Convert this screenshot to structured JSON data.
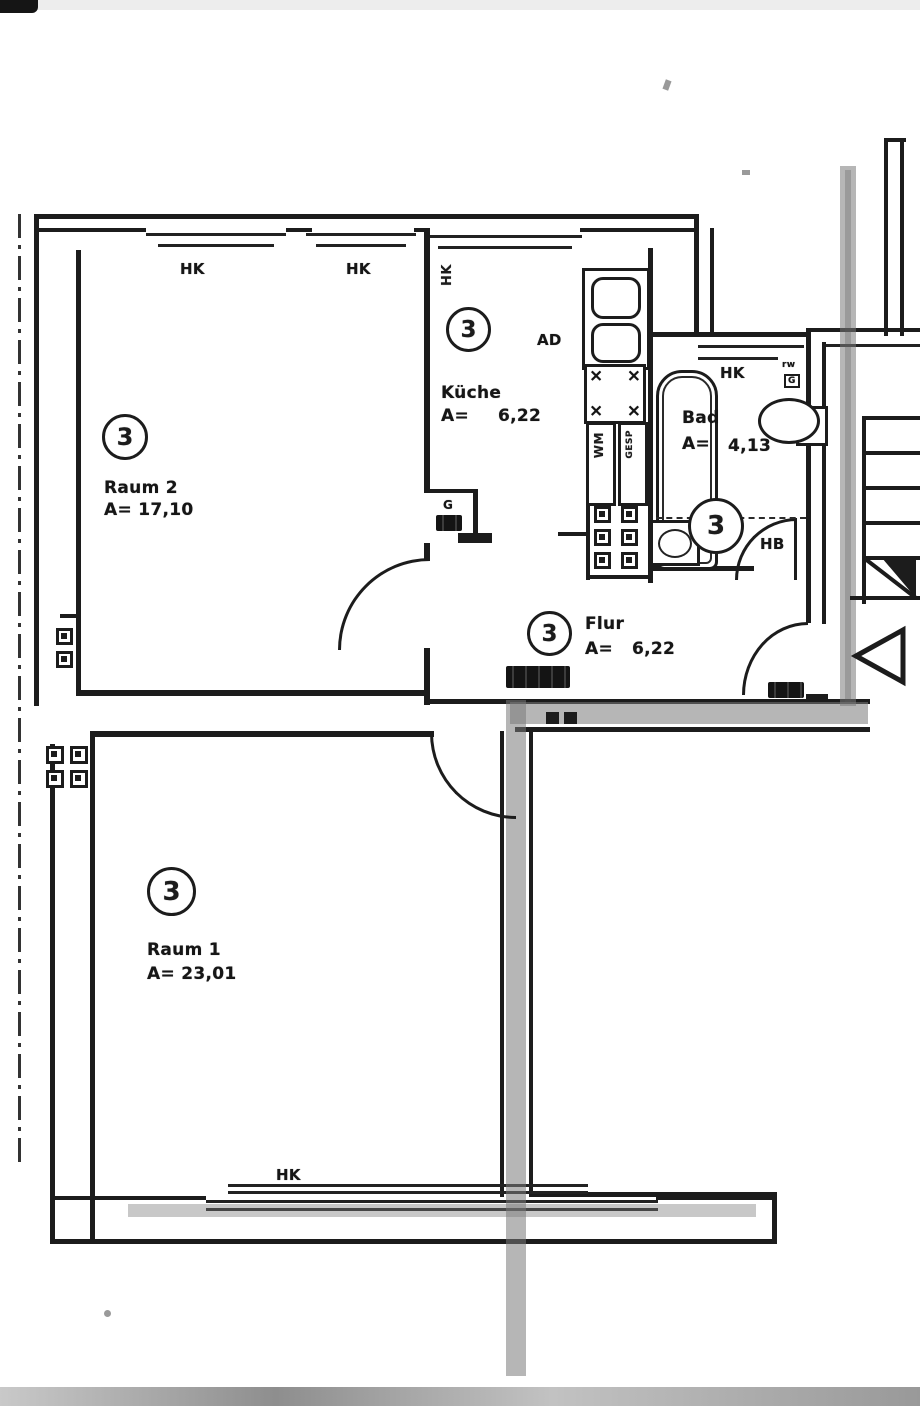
{
  "document": {
    "kind": "apartment floor plan scan"
  },
  "colors": {
    "ink": "#1c1c1c",
    "paper": "#ffffff",
    "highlighter": "#7a7a7a"
  },
  "rooms": {
    "raum2": {
      "unit": "3",
      "name": "Raum 2",
      "area": "A= 17,10"
    },
    "kueche": {
      "unit": "3",
      "name": "Küche",
      "area_prefix": "A=",
      "area_value": "6,22"
    },
    "bad": {
      "unit": "3",
      "name": "Bad",
      "area_prefix": "A=",
      "area_value": "4,13"
    },
    "flur": {
      "unit": "3",
      "name": "Flur",
      "area_prefix": "A=",
      "area_value": "6,22"
    },
    "raum1": {
      "unit": "3",
      "name": "Raum 1",
      "area": "A= 23,01"
    }
  },
  "labels": {
    "radiator": "HK",
    "vent": "AD",
    "washing_machine": "WM",
    "appliance": "GESP",
    "hand_basin": "HB",
    "gas": "G",
    "toilet_tag_1": "rw",
    "toilet_tag_2": "G",
    "burner": "×"
  }
}
